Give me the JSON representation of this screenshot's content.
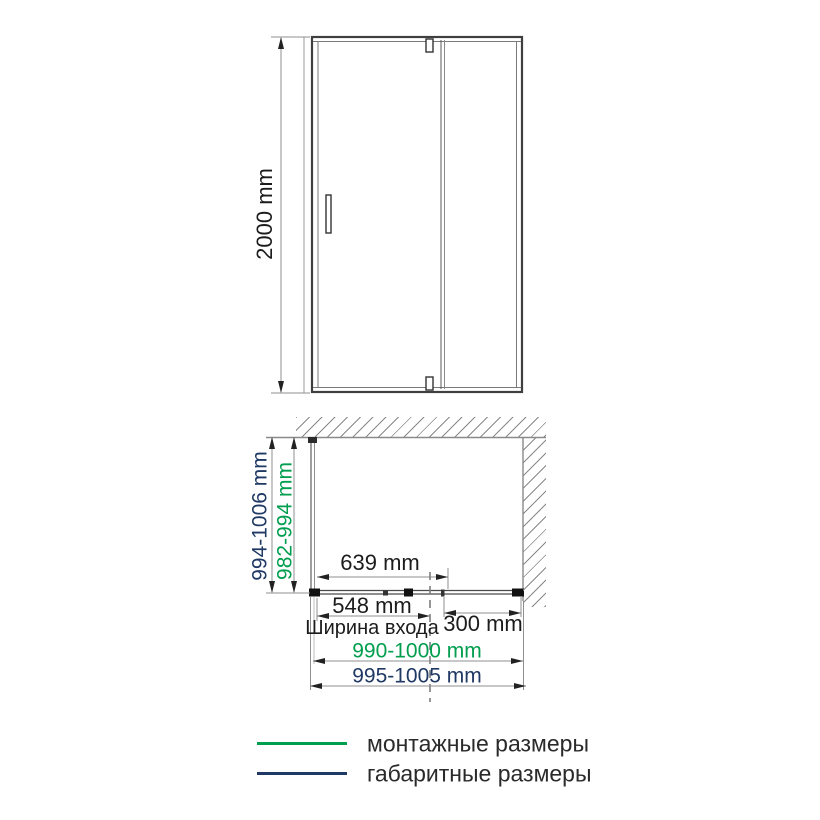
{
  "colors": {
    "mounting_green": "#009e4e",
    "overall_navy": "#1f3864"
  },
  "elevation": {
    "height_label": "2000 mm"
  },
  "plan": {
    "overall_depth_label": "994-1006 mm",
    "mounting_depth_label": "982-994 mm",
    "door_width_label": "639 mm",
    "entrance_width_label": "548 mm",
    "entrance_caption": "Ширина входа",
    "fixed_panel_label": "300 mm",
    "mounting_width_label": "990-1000 mm",
    "overall_width_label": "995-1005 mm"
  },
  "legend": {
    "items": [
      {
        "label": "монтажные размеры",
        "color": "#009e4e"
      },
      {
        "label": "габаритные размеры",
        "color": "#1f3864"
      }
    ]
  }
}
